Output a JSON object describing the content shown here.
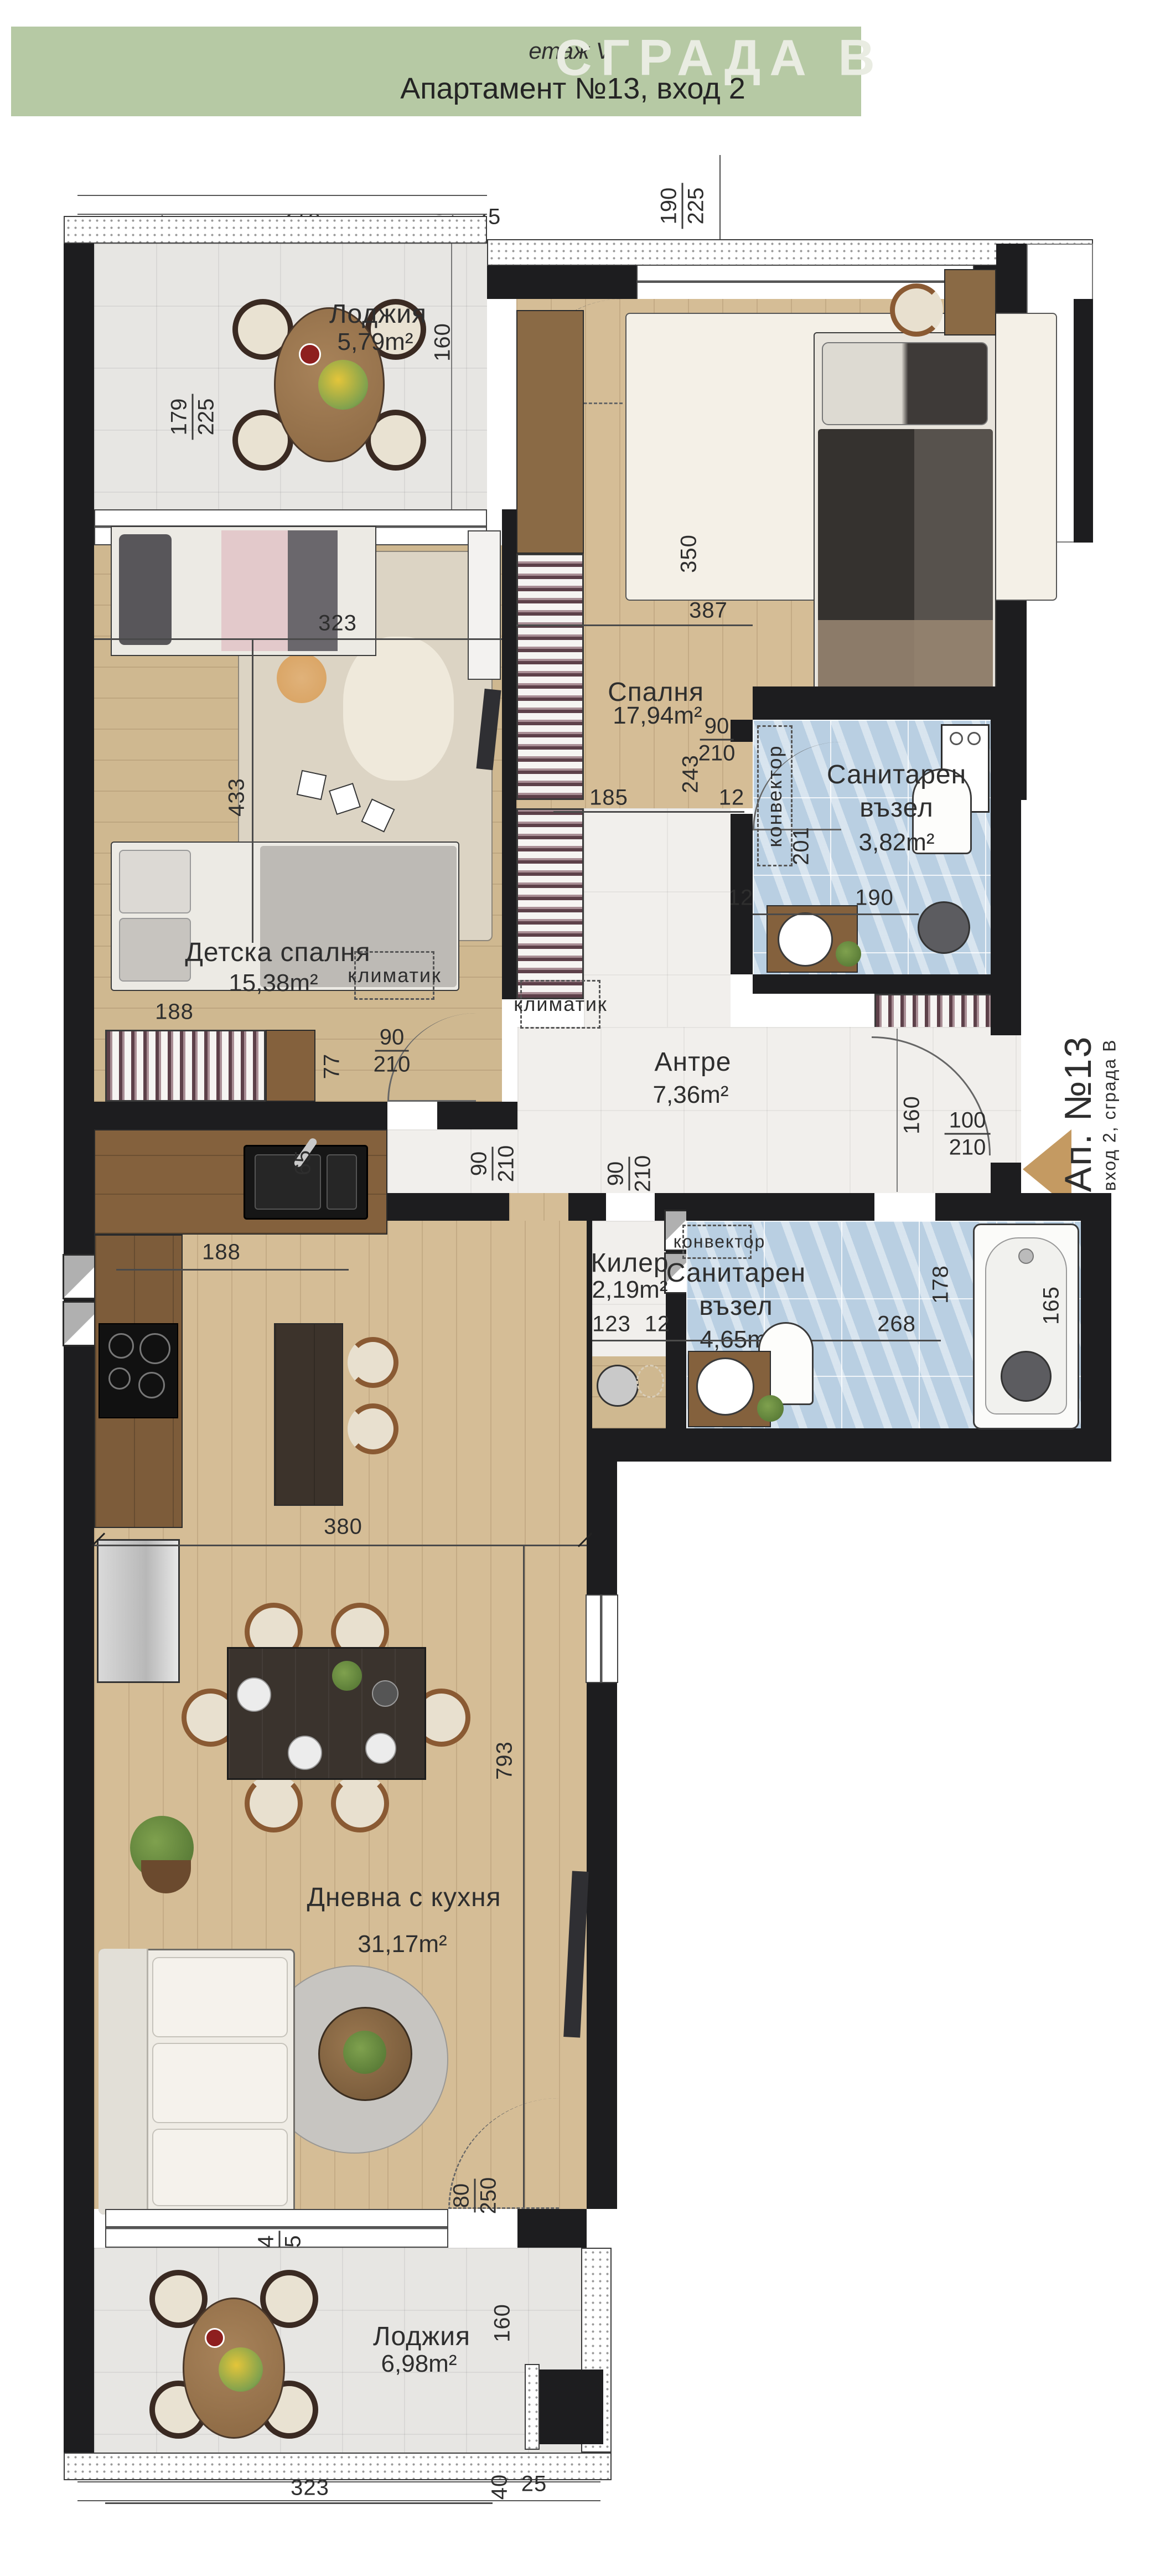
{
  "header": {
    "floor": "етаж V",
    "title": "Апартамент №13, вход 2",
    "building": "СГРАДА В"
  },
  "entrance": {
    "apartment": "Ап. №13",
    "sub": "вход 2, сграда В"
  },
  "rooms": [
    {
      "name": "Лоджия",
      "area": "5,79m²"
    },
    {
      "name": "Спалня",
      "area": "17,94m²"
    },
    {
      "name": "Санитарен възел",
      "area": "3,82m²"
    },
    {
      "name": "Детска спалня",
      "area": "15,38m²"
    },
    {
      "name": "Антре",
      "area": "7,36m²"
    },
    {
      "name": "Килер",
      "area": "2,19m²"
    },
    {
      "name": "Санитарен възел",
      "area": "4,65m²"
    },
    {
      "name": "Дневна с кухня",
      "area": "31,17m²"
    },
    {
      "name": "Лоджия",
      "area": "6,98m²"
    }
  ],
  "equipment": {
    "ac": "климатик",
    "convector": "конвектор"
  },
  "dims": [
    "278",
    "40",
    "25",
    "190",
    "225",
    "80",
    "250",
    "160",
    "179",
    "225",
    "350",
    "387",
    "323",
    "433",
    "90",
    "210",
    "201",
    "12",
    "190",
    "185",
    "12",
    "243",
    "90",
    "210",
    "90",
    "210",
    "90",
    "210",
    "160",
    "100",
    "210",
    "123",
    "12",
    "268",
    "178",
    "165",
    "188",
    "77",
    "65",
    "188",
    "380",
    "793",
    "224",
    "225",
    "80",
    "250",
    "160",
    "323",
    "40",
    "25"
  ],
  "colors": {
    "header_green": "#b6c9a4",
    "building_text": "#e9ece2",
    "wall": "#1d1d1f",
    "bath_tile": "#b9cfe2",
    "entrance_arrow": "#c49a62"
  }
}
